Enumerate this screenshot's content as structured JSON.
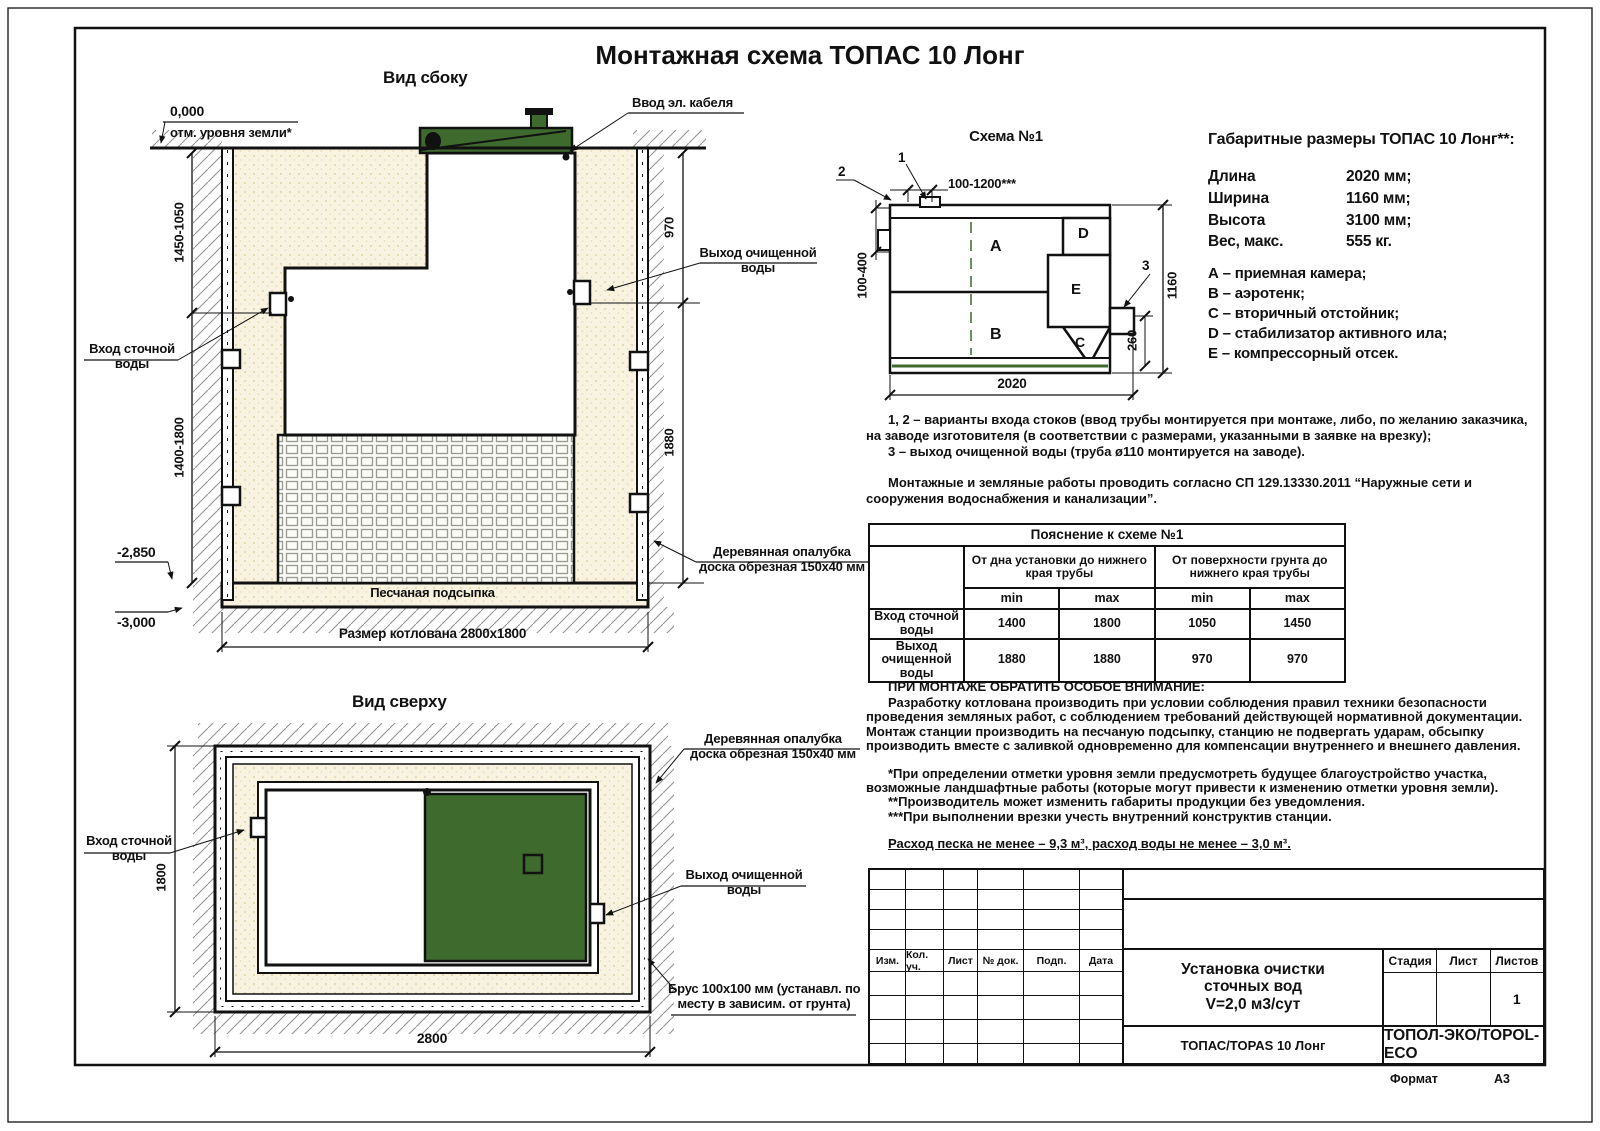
{
  "title": "Монтажная схема ТОПАС 10 Лонг",
  "colors": {
    "green": "#3e6a2d",
    "sand": "#f8f3e1",
    "line": "#111111"
  },
  "side_view": {
    "label": "Вид сбоку",
    "zero_mark": "0,000",
    "zero_note": "отм. уровня земли*",
    "cable_label": "Ввод эл. кабеля",
    "outlet_l1": "Выход очищенной",
    "outlet_l2": "воды",
    "inlet_l1": "Вход сточной",
    "inlet_l2": "воды",
    "formwork_l1": "Деревянная опалубка",
    "formwork_l2": "доска обрезная 150х40 мм",
    "sand_label": "Песчаная подсыпка",
    "pit_label": "Размер котлована 2800х1800",
    "dim_left_top": "1450-1050",
    "dim_left_bottom": "1400-1800",
    "dim_right_top": "970",
    "dim_right_bottom": "1880",
    "mark_mid": "-2,850",
    "mark_bottom": "-3,000"
  },
  "schema": {
    "title": "Схема №1",
    "comp": {
      "a": "A",
      "b": "B",
      "c": "C",
      "d": "D",
      "e": "E"
    },
    "callout_1": "1",
    "callout_2": "2",
    "callout_3": "3",
    "dim_top": "100-1200***",
    "dim_left": "100-400",
    "dim_right": "1160",
    "dim_offset": "260",
    "dim_bottom": "2020"
  },
  "specs": {
    "title": "Габаритные размеры ТОПАС 10 Лонг**:",
    "rows": [
      {
        "label": "Длина",
        "value": "2020 мм;"
      },
      {
        "label": "Ширина",
        "value": "1160 мм;"
      },
      {
        "label": "Высота",
        "value": "3100 мм;"
      },
      {
        "label": "Вес, макс.",
        "value": "555 кг."
      }
    ],
    "legend": [
      "А – приемная камера;",
      "В – аэротенк;",
      "С – вторичный отстойник;",
      "D – стабилизатор активного ила;",
      "Е – компрессорный отсек."
    ]
  },
  "notes": {
    "n12": "1, 2 – варианты входа стоков (ввод трубы монтируется при монтаже, либо, по желанию заказчика, на заводе изготовителя (в соответствии с размерами, указанными в заявке на врезку);",
    "n3": "3 – выход очищенной воды (труба ø110 монтируется на заводе).",
    "sp": "Монтажные и земляные работы проводить согласно СП 129.13330.2011 “Наружные сети и сооружения водоснабжения и канализации”."
  },
  "expl_table": {
    "title": "Пояснение к схеме №1",
    "group1": "От дна установки до нижнего края трубы",
    "group2": "От поверхности грунта до нижнего края трубы",
    "min": "min",
    "max": "max",
    "rows": [
      {
        "name": "Вход сточной воды",
        "v": [
          "1400",
          "1800",
          "1050",
          "1450"
        ]
      },
      {
        "name": "Выход очищенной воды",
        "v": [
          "1880",
          "1880",
          "970",
          "970"
        ]
      }
    ]
  },
  "warning": {
    "title": "ПРИ МОНТАЖЕ ОБРАТИТЬ ОСОБОЕ ВНИМАНИЕ:",
    "body": "Разработку котлована производить при условии соблюдения правил техники безопасности проведения земляных работ, с соблюдением требований действующей нормативной документации. Монтаж станции производить на песчаную подсыпку, станцию не подвергать ударам, обсыпку производить вместе с заливкой одновременно для компенсации внутреннего и внешнего давления.",
    "note1": "*При определении отметки уровня земли предусмотреть будущее благоустройство участка, возможные ландшафтные работы (которые могут привести к изменению отметки уровня земли).",
    "note2": "**Производитель может изменить габариты продукции без уведомления.",
    "note3": "***При выполнении врезки учесть внутренний конструктив станции.",
    "consumption": "Расход песка не менее – 9,3 м³, расход воды не менее – 3,0 м³."
  },
  "top_view": {
    "label": "Вид сверху",
    "inlet_l1": "Вход сточной",
    "inlet_l2": "воды",
    "outlet_l1": "Выход очищенной",
    "outlet_l2": "воды",
    "formwork_l1": "Деревянная опалубка",
    "formwork_l2": "доска обрезная 150х40 мм",
    "beam_l1": "Брус 100х100 мм (устанавл. по",
    "beam_l2": "месту в зависим. от грунта)",
    "dim_width": "2800",
    "dim_height": "1800"
  },
  "title_block": {
    "cols": [
      "Изм.",
      "Кол. уч.",
      "Лист",
      "№ док.",
      "Подп.",
      "Дата"
    ],
    "doc1": "Установка очистки",
    "doc2": "сточных вод",
    "doc3": "V=2,0 м3/сут",
    "product": "ТОПАС/TOPAS 10 Лонг",
    "company": "ТОПОЛ-ЭКО/TOPOL-ECO",
    "stage": "Стадия",
    "sheet": "Лист",
    "sheets": "Листов",
    "sheets_value": "1",
    "format_label": "Формат",
    "format_value": "А3"
  }
}
